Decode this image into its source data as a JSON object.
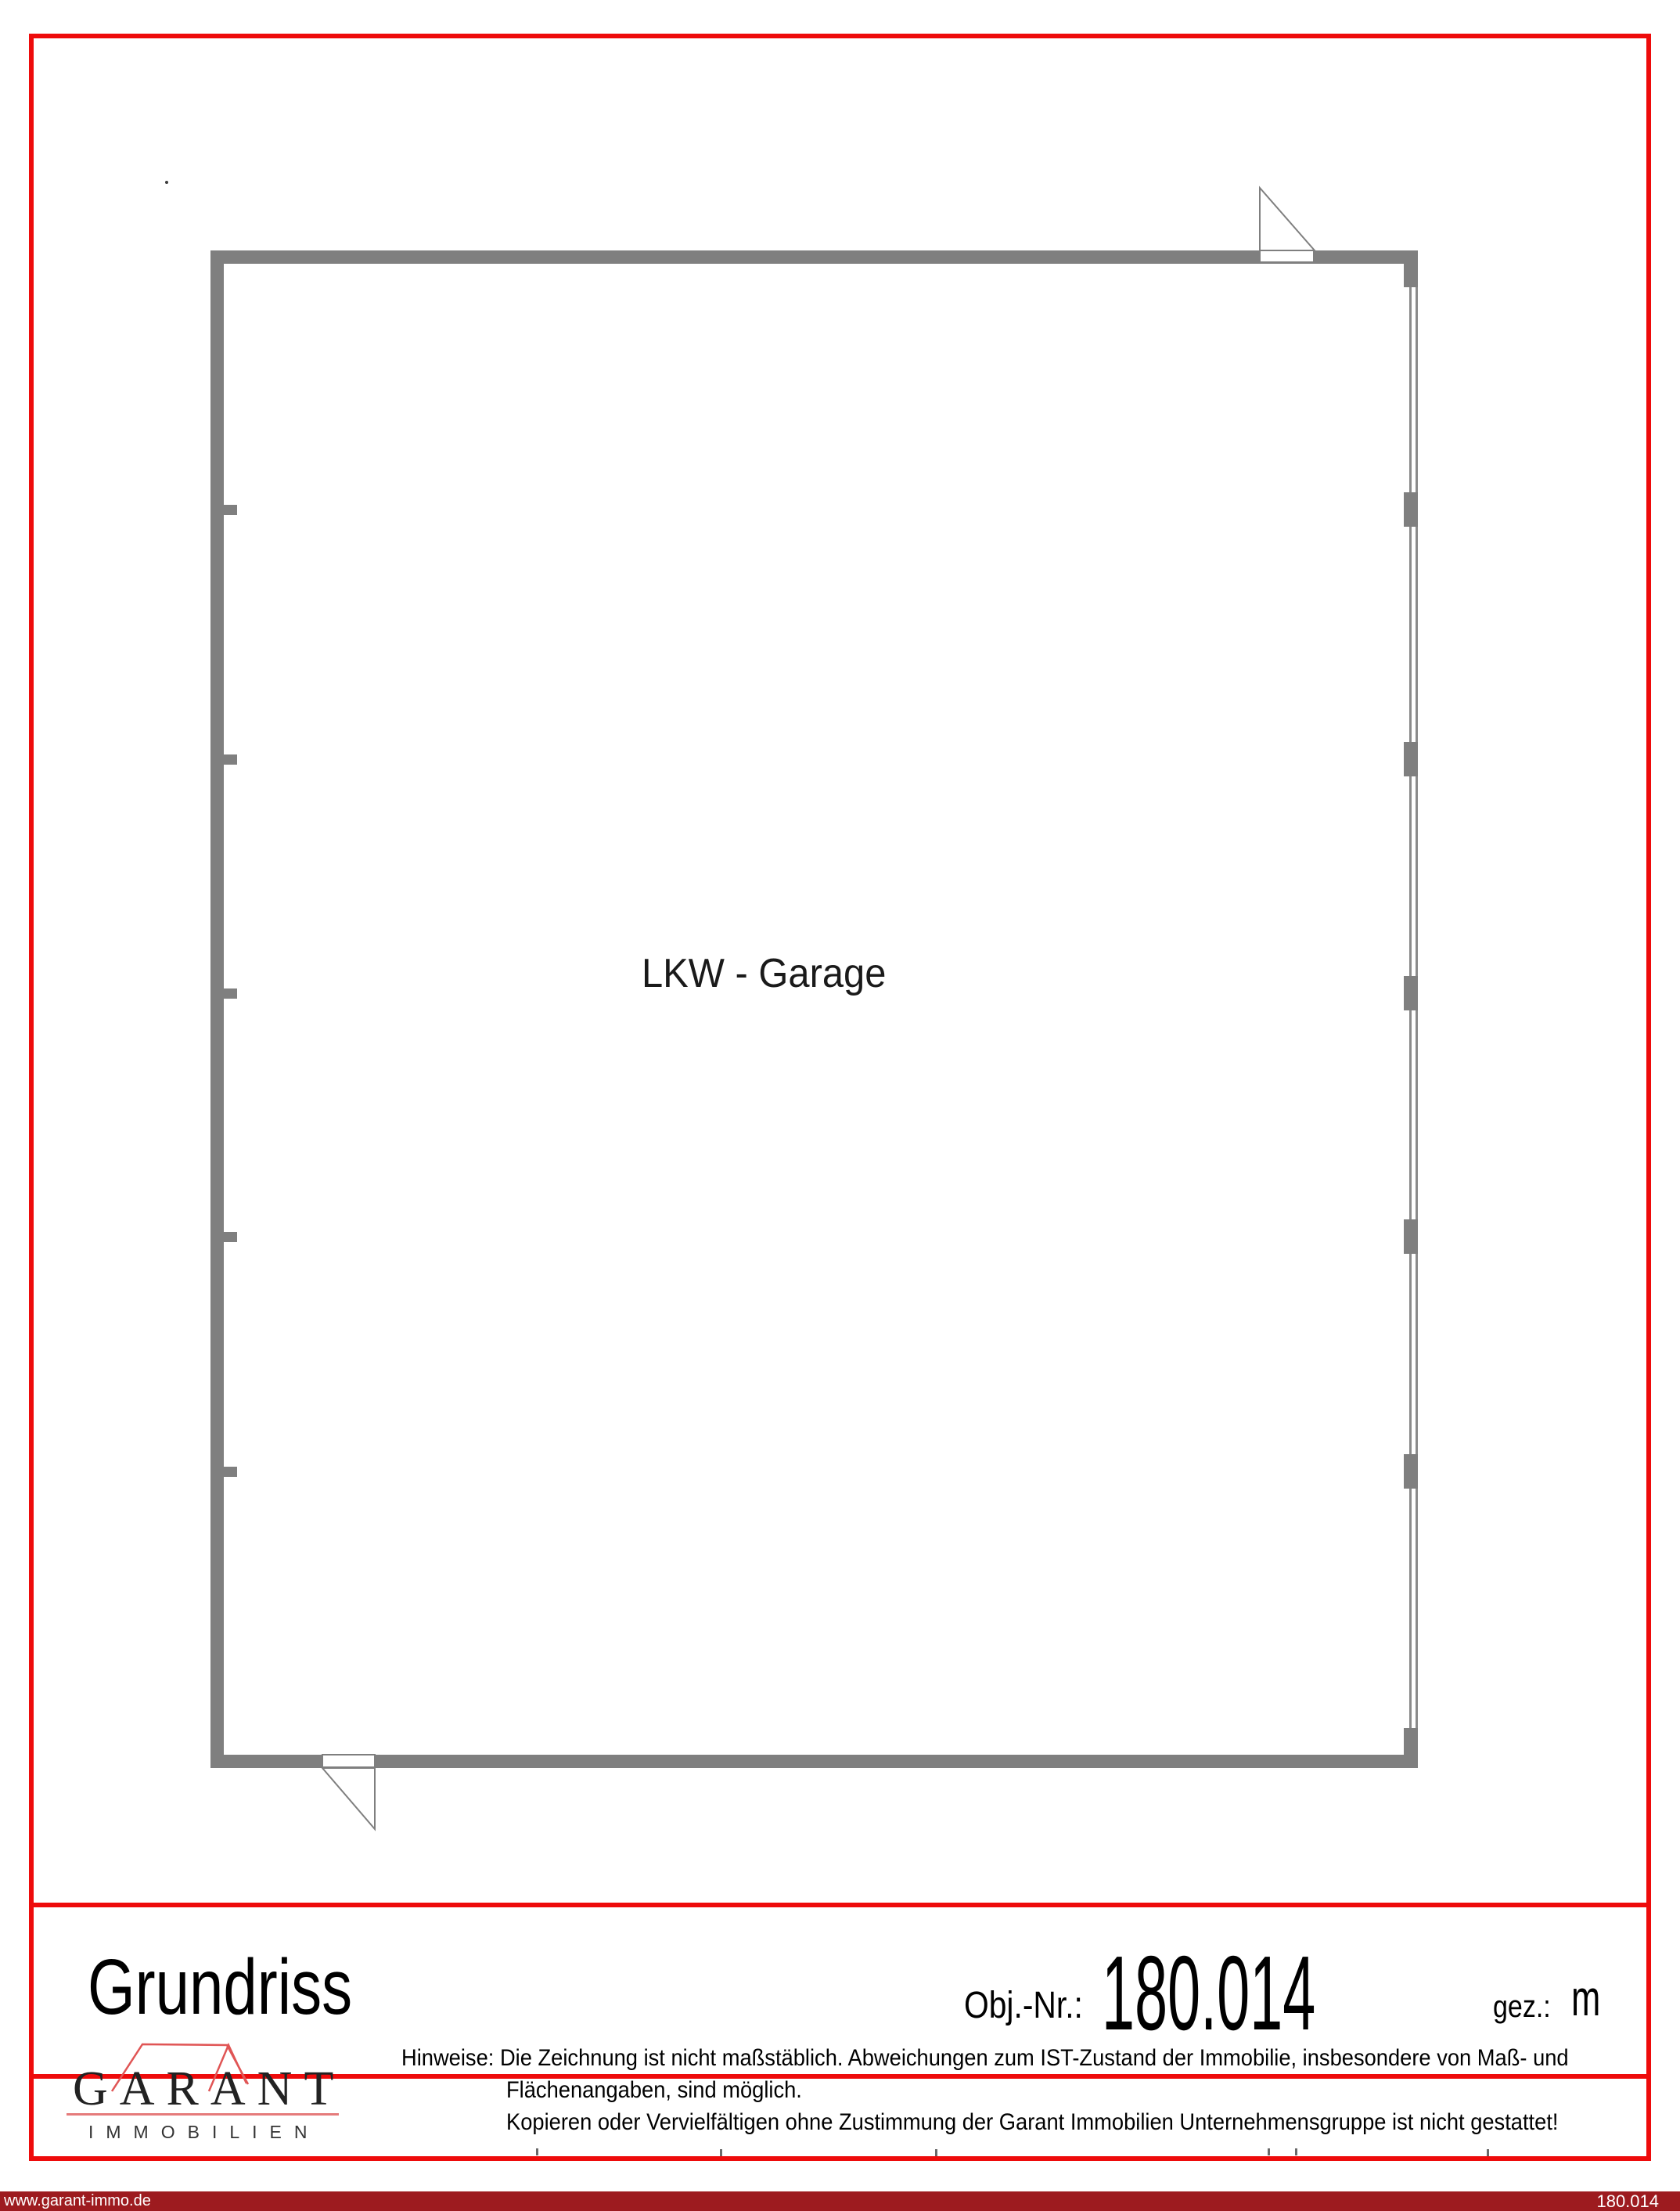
{
  "page": {
    "background": "#ffffff",
    "accent_red": "#ee0b0b"
  },
  "floorplan": {
    "room_label": "LKW - Garage",
    "wall_color": "#7f7f7f"
  },
  "title_band": {
    "title": "Grundriss",
    "obj_label": "Obj.-Nr.:",
    "obj_value": "180.014",
    "gez_label": "gez.:",
    "gez_value": "m"
  },
  "logo": {
    "wordmark": "GARANT",
    "subtitle": "IMMOBILIEN",
    "roof_color": "#e05555"
  },
  "disclaimer": {
    "label": "Hinweise:",
    "line1": "Die Zeichnung ist nicht maßstäblich. Abweichungen zum IST-Zustand der Immobilie, insbesondere von Maß- und",
    "line2": "Flächenangaben, sind möglich.",
    "line3": "Kopieren oder Vervielfältigen ohne Zustimmung der Garant Immobilien Unternehmensgruppe ist nicht gestattet!"
  },
  "footer": {
    "website": "www.garant-immo.de",
    "object_number": "180.014",
    "bar_color": "#9d1b1f"
  }
}
